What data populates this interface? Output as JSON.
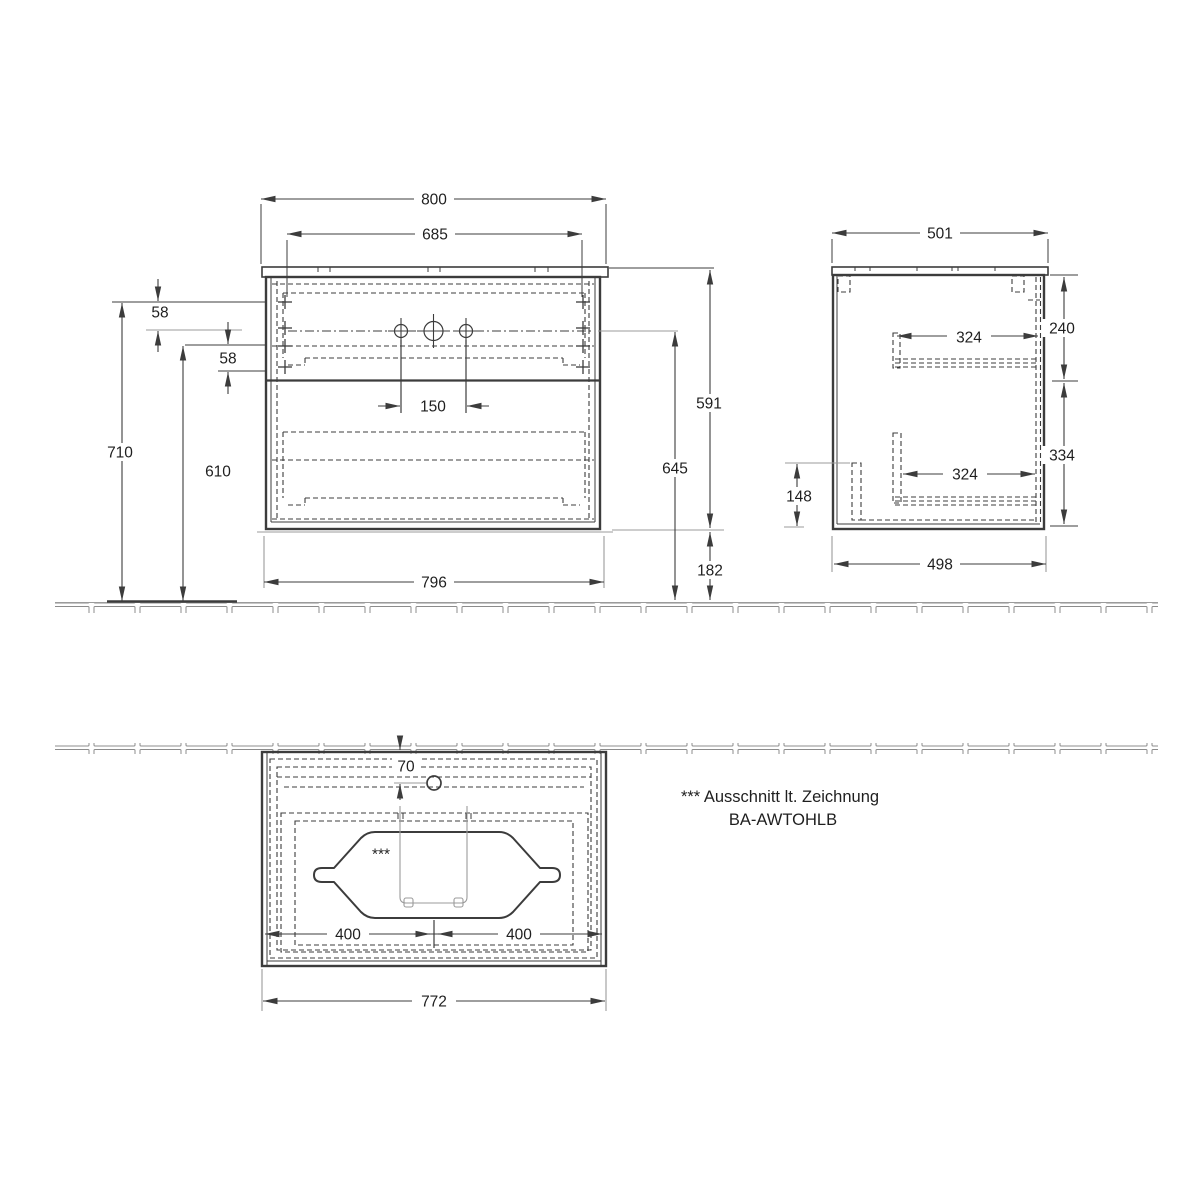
{
  "drawing": {
    "front": {
      "d800": "800",
      "d685": "685",
      "d58_top": "58",
      "d58_bottom": "58",
      "d710": "710",
      "d610": "610",
      "d150": "150",
      "d591": "591",
      "d645": "645",
      "d182": "182",
      "d796": "796"
    },
    "side": {
      "d501": "501",
      "d324_top": "324",
      "d240": "240",
      "d324_bottom": "324",
      "d334": "334",
      "d148": "148",
      "d498": "498"
    },
    "plan": {
      "d70": "70",
      "d400_left": "400",
      "d400_right": "400",
      "d772": "772",
      "cutout_marker": "***"
    },
    "note": {
      "line1": "*** Ausschnitt lt. Zeichnung",
      "line2": "BA-AWTOHLB"
    },
    "colors": {
      "line": "#3c3c3c",
      "muted": "#9b9b9b",
      "tile_border": "#8c8c8c",
      "background": "#ffffff",
      "text": "#1f1f1f"
    }
  }
}
